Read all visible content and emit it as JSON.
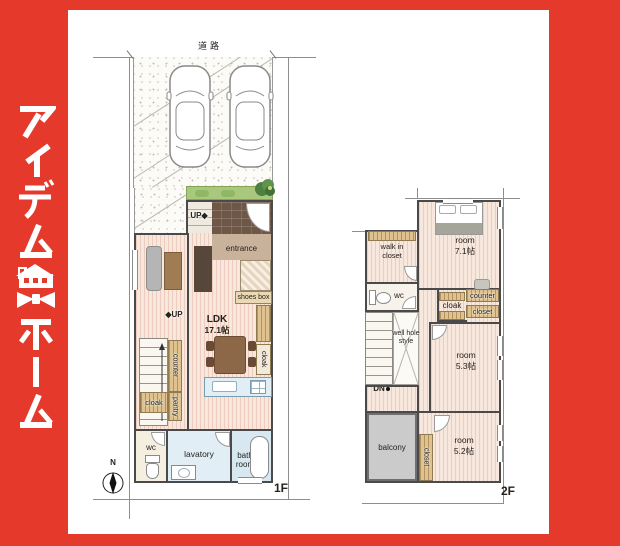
{
  "brand": {
    "name": "アイデムホーム"
  },
  "plan1f": {
    "road": "道路",
    "entrance_up": "UP◆",
    "entrance": "entrance",
    "shoes_box": "shoes box",
    "ldk_label": "LDK",
    "ldk_size": "17.1帖",
    "stairs_up": "◆UP",
    "counter": "counter",
    "cloak": "cloak",
    "pantry": "pantry",
    "cloak2": "cloak",
    "wc": "wc",
    "lavatory": "lavatory",
    "bathroom": "bath room",
    "floor_tag": "1F",
    "compass": "N"
  },
  "plan2f": {
    "wic": "walk in closet",
    "room_71_label": "room",
    "room_71_size": "7.1帖",
    "wc": "wc",
    "cloak": "cloak",
    "counter": "counter",
    "closet": "closet",
    "well": "well hole style",
    "dn": "DN",
    "room_53_label": "room",
    "room_53_size": "5.3帖",
    "balcony": "balcony",
    "closet_v": "closet",
    "room_52_label": "room",
    "room_52_size": "5.2帖",
    "floor_tag": "2F"
  },
  "colors": {
    "brand_red": "#e5392b",
    "floor": "#f8e7dd",
    "wall": "#4a4a4a",
    "water_blue": "#e2eef5",
    "planting_green": "#a9c87d",
    "balcony_gray": "#cbcbcb",
    "storage_tan": "#dfc28f"
  }
}
